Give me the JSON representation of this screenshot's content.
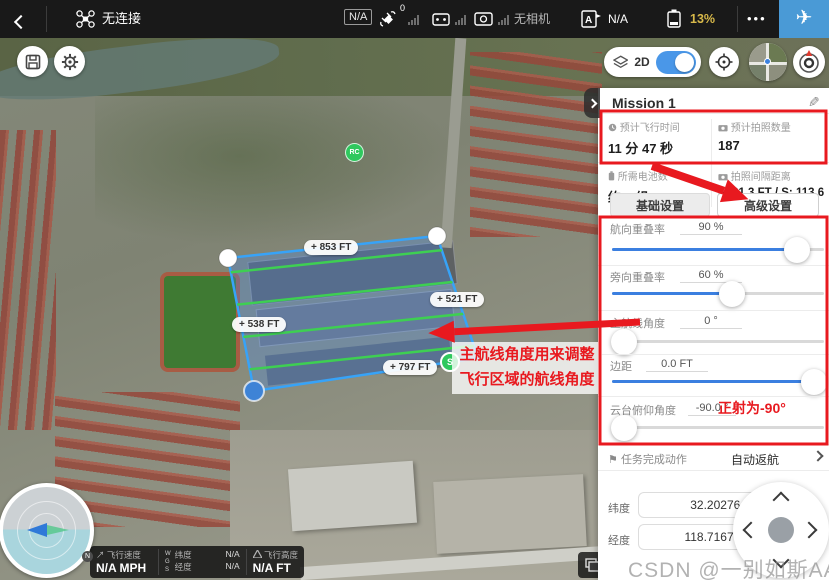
{
  "topbar": {
    "connection": "无连接",
    "mode_badge": "N/A",
    "gps_count": "0",
    "camera_status": "无相机",
    "rc_status": "N/A",
    "battery": "13%",
    "more_icon": "•••",
    "takeoff_icon": "✈"
  },
  "map_controls": {
    "view_label": "2D",
    "rc_marker": "RC",
    "start_marker": "S"
  },
  "flight_area": {
    "edge_labels": [
      "+ 853 FT",
      "+ 521 FT",
      "+ 538 FT",
      "+ 797 FT"
    ]
  },
  "panel": {
    "title": "Mission 1",
    "edit_icon": "✎",
    "stats": [
      {
        "label": "预计飞行时间",
        "value": "11 分 47 秒"
      },
      {
        "label": "预计拍照数量",
        "value": "187"
      },
      {
        "label": "所需电池数",
        "value": "约 1 组"
      },
      {
        "label": "拍照间隔距离",
        "value": "F: 21.3 FT / S: 113.6 FT"
      }
    ],
    "tabs": [
      {
        "label": "基础设置"
      },
      {
        "label": "高级设置"
      }
    ],
    "sliders": [
      {
        "label": "航向重叠率",
        "value": "90 %"
      },
      {
        "label": "旁向重叠率",
        "value": "60 %"
      },
      {
        "label": "主航线角度",
        "value": "0 °"
      },
      {
        "label": "边距",
        "value": "0.0 FT"
      },
      {
        "label": "云台俯仰角度",
        "value": "-90.0 °"
      }
    ],
    "finish_action": {
      "flag_icon": "⚑",
      "label": "任务完成动作",
      "value": "自动返航"
    },
    "coords": {
      "lat_label": "纬度",
      "lat_value": "32.202764195",
      "lon_label": "经度",
      "lon_value": "118.716763493"
    }
  },
  "telemetry": {
    "speed_icon": "↗",
    "speed_label": "飞行速度",
    "speed_value": "N/A MPH",
    "wgs": [
      "W",
      "G",
      "S"
    ],
    "lat_label": "纬度",
    "lat_value": "N/A",
    "lon_label": "经度",
    "lon_value": "N/A",
    "alt_label": "飞行高度",
    "alt_value": "N/A FT"
  },
  "annotations": {
    "note_line1": "主航线角度用来调整",
    "note_line2": "飞行区域的航线角度",
    "ortho_note": "正射为-90°"
  },
  "watermark": "CSDN @一别如斯AA",
  "colors": {
    "accent": "#3b7fe0",
    "red": "#e8191f",
    "polygon": "#37a3f8",
    "scanline": "#3ecf52",
    "battery_warn": "#d8b94a"
  }
}
